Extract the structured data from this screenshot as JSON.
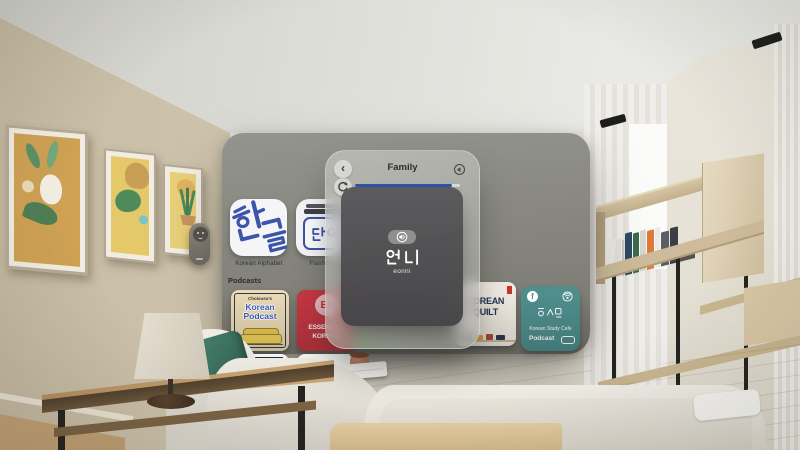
{
  "app_window": {
    "apps": [
      {
        "label": "Korean Alphabet",
        "icon_text": "한글"
      },
      {
        "label": "Flashcards",
        "icon_text": "단어"
      }
    ],
    "section_label": "Podcasts",
    "podcasts": [
      {
        "author": "Choisusu's",
        "title1": "Korean",
        "title2": "Podcast"
      },
      {
        "badge": "EK",
        "title1": "ESSENTIAL",
        "title2": "KOREAN"
      },
      {
        "title": "SPONGE"
      },
      {
        "title1": "KOREAN",
        "title2": "QUILT"
      },
      {
        "facebook_initial": "f",
        "name": "Korean Study Cafe",
        "sub": "Podcast"
      }
    ]
  },
  "flashcard_panel": {
    "back_glyph": "‹",
    "title": "Family",
    "word": "언니",
    "romanization": "eonni",
    "progress_percent": 92
  },
  "colors": {
    "accent_blue": "#2c55a5",
    "icon_blue": "#3b55a8",
    "ek_red": "#c53742",
    "cafe_teal": "#4e8e8d",
    "quilt_navy": "#253352"
  }
}
